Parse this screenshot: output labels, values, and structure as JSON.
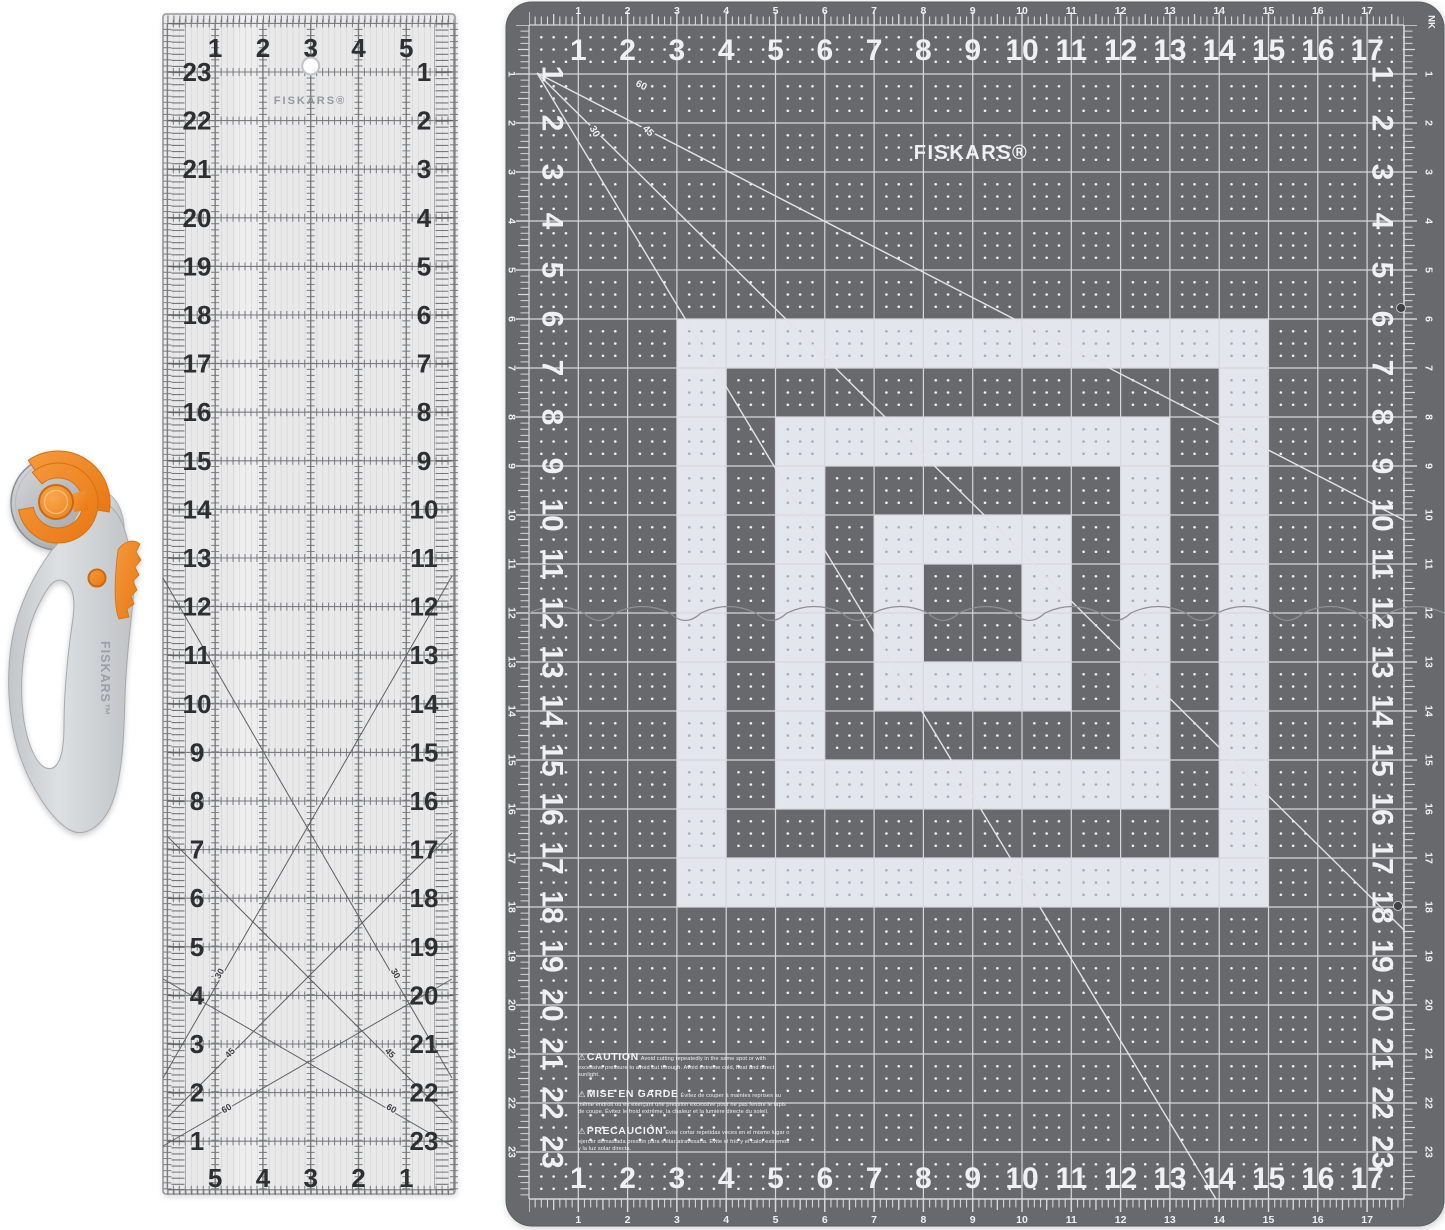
{
  "cutter": {
    "brand": "FISKARS™",
    "colors": {
      "orange": "#f08a28",
      "orange_dark": "#d06d0e",
      "handle": "#d3d5d8",
      "handle_dark": "#aaadb1",
      "blade": "#c0c3c6",
      "brand_text": "#9aa0a8"
    }
  },
  "ruler": {
    "brand": "FISKARS®",
    "top_numbers": [
      "1",
      "2",
      "3",
      "4",
      "5"
    ],
    "bottom_numbers": [
      "5",
      "4",
      "3",
      "2",
      "1"
    ],
    "left_numbers": [
      "23",
      "22",
      "21",
      "20",
      "19",
      "18",
      "17",
      "16",
      "15",
      "14",
      "13",
      "12",
      "11",
      "10",
      "9",
      "8",
      "7",
      "6",
      "5",
      "4",
      "3",
      "2",
      "1"
    ],
    "right_numbers": [
      "1",
      "2",
      "3",
      "4",
      "5",
      "6",
      "7",
      "8",
      "9",
      "10",
      "11",
      "12",
      "13",
      "14",
      "15",
      "16",
      "17",
      "18",
      "19",
      "20",
      "21",
      "22",
      "23"
    ],
    "angle_labels": [
      "30",
      "45",
      "60"
    ],
    "colors": {
      "body": "#e9e9ea",
      "line": "#7c7d80",
      "fine": "#c6c7c9",
      "number": "#2e2f31",
      "diagonal": "#5f6062",
      "brand": "#96989a"
    }
  },
  "mat": {
    "brand": "FISKARS®",
    "corner_mark": "NK",
    "top_numbers": [
      "1",
      "2",
      "3",
      "4",
      "5",
      "6",
      "7",
      "8",
      "9",
      "10",
      "11",
      "12",
      "13",
      "14",
      "15",
      "16",
      "17"
    ],
    "bottom_numbers": [
      "1",
      "2",
      "3",
      "4",
      "5",
      "6",
      "7",
      "8",
      "9",
      "10",
      "11",
      "12",
      "13",
      "14",
      "15",
      "16",
      "17"
    ],
    "left_numbers": [
      "1",
      "2",
      "3",
      "4",
      "5",
      "6",
      "7",
      "8",
      "9",
      "10",
      "11",
      "12",
      "13",
      "14",
      "15",
      "16",
      "17",
      "18",
      "19",
      "20",
      "21",
      "22",
      "23"
    ],
    "right_numbers": [
      "1",
      "2",
      "3",
      "4",
      "5",
      "6",
      "7",
      "8",
      "9",
      "10",
      "11",
      "12",
      "13",
      "14",
      "15",
      "16",
      "17",
      "18",
      "19",
      "20",
      "21",
      "22",
      "23"
    ],
    "diagonal_labels": [
      "60",
      "45",
      "30"
    ],
    "colors": {
      "surface": "#67696c",
      "grid": "#d6d8da",
      "cell": "#e4e6ee",
      "dots_light": "#f4f5f7",
      "dots_dark": "#a7abb6",
      "number": "#eef0f2",
      "diagonal": "#e2e3e6"
    },
    "cautions": [
      {
        "icon": "⚠",
        "title": "CAUTION",
        "text": "Avoid cutting repeatedly in the same spot or with excessive pressure to avoid cut through. Avoid extreme cold, heat and direct sunlight."
      },
      {
        "icon": "⚠",
        "title": "MISE EN GARDE",
        "text": "Évitez de couper à maintes reprises au même endroit ou en exerçant une pression excessive pour ne pas fendre le tapis de coupe. Évitez le froid extrême, la chaleur et la lumière directe du soleil."
      },
      {
        "icon": "⚠",
        "title": "PRECAUCIÓN",
        "text": "Evite cortar repetidas veces en el mismo lugar o ejercer demasiada presión para evitar atravesarla. Evite el frío y el calor extremos y la luz solar directa."
      }
    ]
  }
}
